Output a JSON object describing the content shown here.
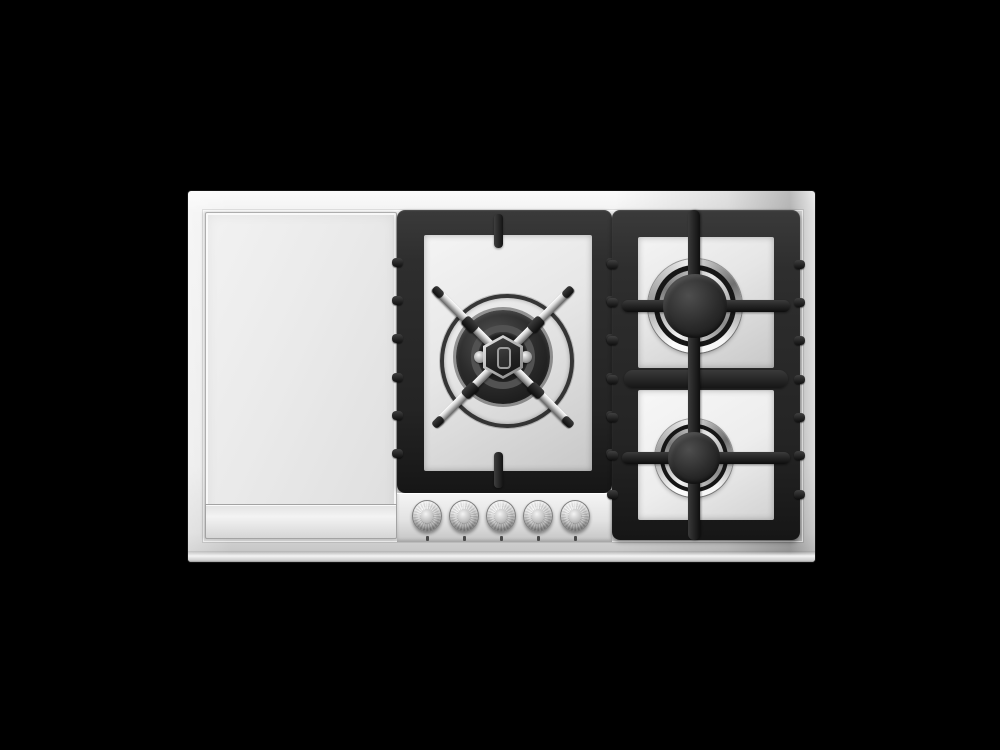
{
  "scene": {
    "background_color": "#000000"
  },
  "cooktop": {
    "colors": {
      "bg": "#000000",
      "frame_light": "#fbfbfb",
      "frame_mid": "#e9e9e9",
      "frame_dark": "#bdbdbd",
      "grate": "#2e2e2e",
      "grate_dark": "#161616",
      "panel_light": "#f4f4f4",
      "panel_dark": "#c8c8c8",
      "chrome_light": "#d9d9d9",
      "chrome_dark": "#808080",
      "cap_dark": "#232323"
    },
    "modules": {
      "griddle": {
        "id": "griddle-plate"
      },
      "center": {
        "id": "center-wok-module"
      },
      "right": {
        "id": "right-dual-burner-module"
      }
    },
    "burners": [
      {
        "id": "wok-center-burner",
        "kind": "wok-with-cross-grate"
      },
      {
        "id": "right-top-burner",
        "kind": "round-large"
      },
      {
        "id": "right-bottom-burner",
        "kind": "round-small"
      }
    ],
    "knobs": [
      {
        "id": "knob-1"
      },
      {
        "id": "knob-2"
      },
      {
        "id": "knob-3"
      },
      {
        "id": "knob-4"
      },
      {
        "id": "knob-5"
      }
    ]
  }
}
